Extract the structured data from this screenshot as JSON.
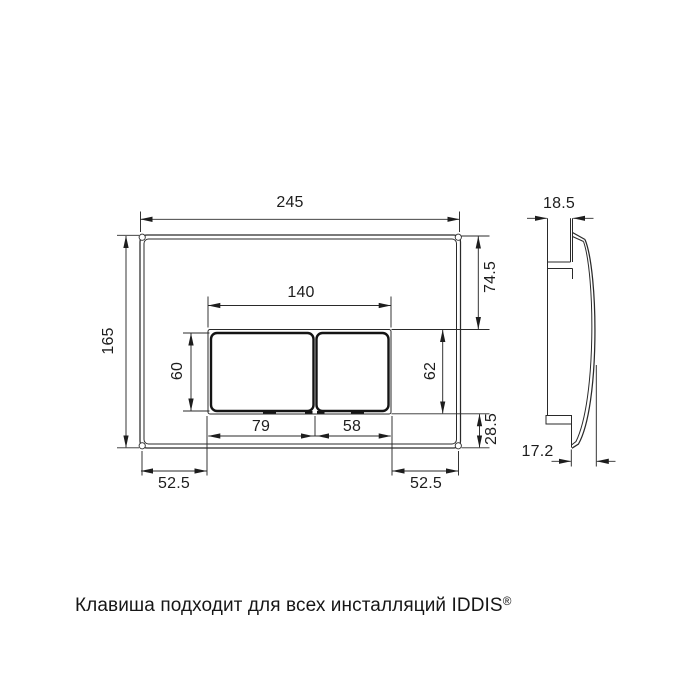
{
  "colors": {
    "line": "#2a2a2a",
    "background": "#ffffff"
  },
  "dimensions": {
    "plate_width": "245",
    "plate_height": "165",
    "opening_width": "140",
    "top_to_opening": "74.5",
    "button_height": "60",
    "opening_height": "62",
    "large_button_width": "79",
    "small_button_width": "58",
    "opening_to_bottom": "28.5",
    "bottom_left_margin": "52.5",
    "bottom_right_margin": "52.5",
    "side_depth_top": "18.5",
    "side_depth_bottom": "17.2"
  },
  "caption": {
    "text": "Клавиша подходит для всех инсталляций IDDIS",
    "trademark": "®"
  }
}
